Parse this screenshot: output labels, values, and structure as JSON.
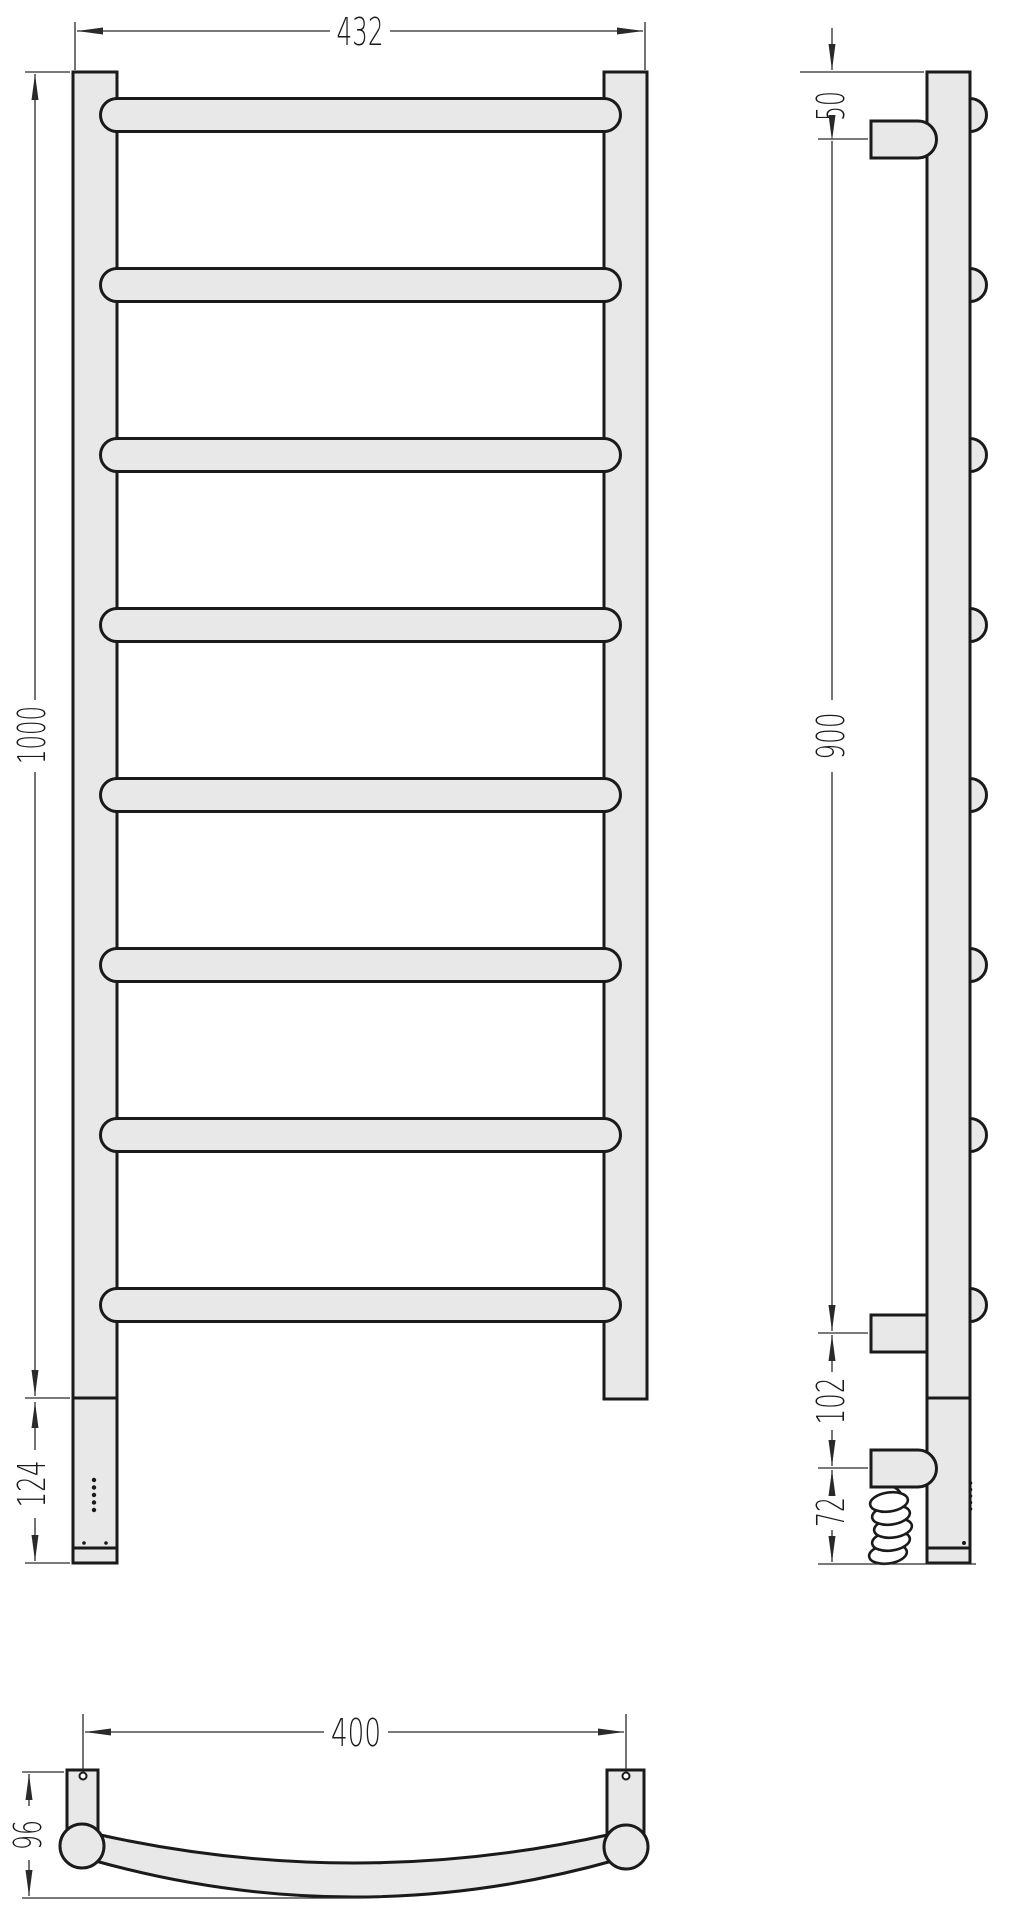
{
  "drawing": {
    "subject": "ladder heated towel rail, three orthographic views with dimensions",
    "colors": {
      "background": "#ffffff",
      "body_fill": "#e8e8e8",
      "outline": "#1a1a1a",
      "dimension_lines": "#2a2a2a"
    },
    "front_view": {
      "bar_count": 8,
      "dims": {
        "overall_width": "432",
        "overall_height": "1000",
        "control_box_height": "124"
      }
    },
    "side_view": {
      "dims": {
        "top_to_upper_bracket": "50",
        "bracket_span": "900",
        "bracket_to_cable_entry": "102",
        "cable_entry_to_bottom": "72"
      }
    },
    "top_view": {
      "dims": {
        "mount_hole_spacing": "400",
        "depth": "96"
      }
    }
  }
}
